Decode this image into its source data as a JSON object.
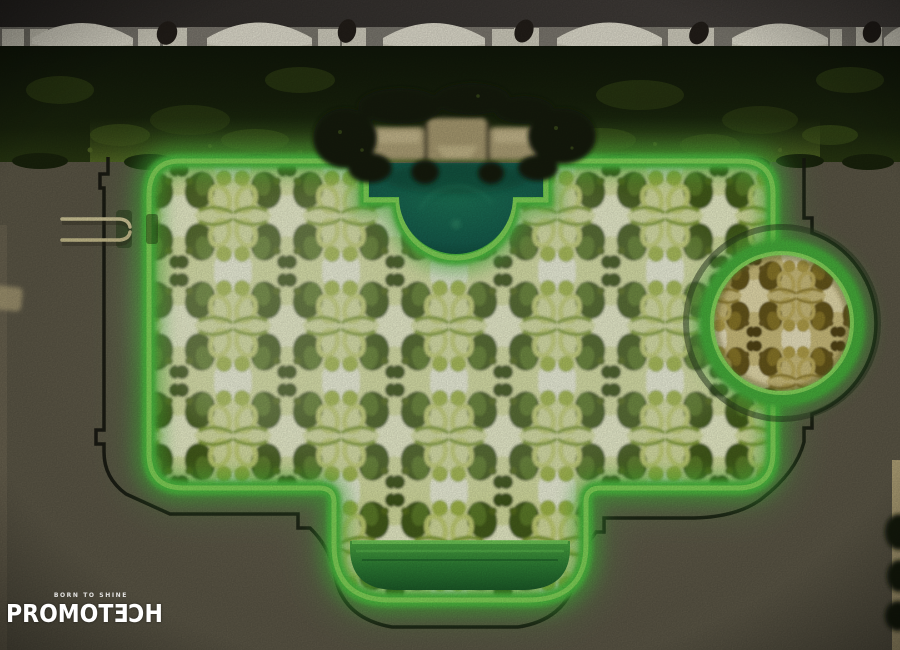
{
  "scene": {
    "type": "night aerial drone photograph",
    "subject": "Resort swimming pool glowing green with a mirrored kaleidoscopic palm-reflection water pattern",
    "elements": [
      "row of white cabana canopies along top walkway",
      "dark trimmed hedge between walkway and pool deck",
      "stone bench structure with overhanging trees at pool top center",
      "dark teal semicircular deep section at pool top center",
      "main rectangular pool with bright green illuminated coping",
      "circular spa with golden illuminated water on right side",
      "rounded step extension at pool bottom center",
      "metal pool ladder on left edge",
      "black paver outline tracing the pool contour on the deck"
    ]
  },
  "watermark": {
    "tagline": "BORN TO SHINE",
    "brand": "PROMOTƎƆH"
  },
  "colors": {
    "pool_glow": "#5ecb4a",
    "coping_highlight": "#8ce05e",
    "pool_pattern": [
      "#f8fce2",
      "#dfe8a6",
      "#a9c04c",
      "#61812a",
      "#47611a"
    ],
    "spa_pattern": [
      "#f6eec8",
      "#d6c782",
      "#baa74e",
      "#8f7c2c",
      "#6b5a1c"
    ],
    "deep_end_teal": "#17664d",
    "deck": "#5f5a49",
    "hedge": "#18220c",
    "walkway": "#393531",
    "canopy": "#e9e6d6",
    "contour_outline": "#16150f",
    "watermark_text": "#ffffff"
  }
}
